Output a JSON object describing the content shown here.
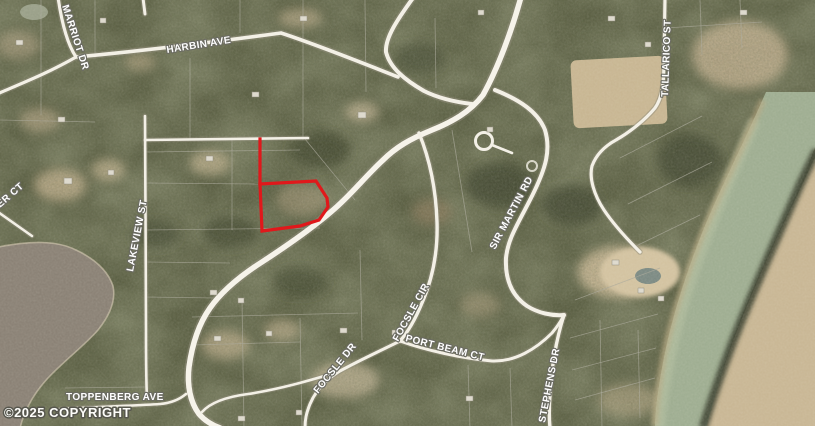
{
  "map": {
    "view": "satellite-aerial-parcel-map",
    "copyright": "©2025 COPYRIGHT",
    "highlight_color": "#e0181b",
    "road_labels": {
      "marriot": "MARRIOT DR",
      "harbin": "HARBIN AVE",
      "er_ct": "ER CT",
      "lakeview": "LAKEVIEW ST",
      "tallarico": "TALLARICO ST",
      "sir_martin": "SIR MARTIN RD",
      "focsle_cir": "FOCSLE CIR",
      "focsle_dr": "FOCSLE DR",
      "port_beam": "PORT BEAM CT",
      "stephens": "STEPHENS DR",
      "toppenberg": "TOPPENBERG AVE"
    }
  }
}
